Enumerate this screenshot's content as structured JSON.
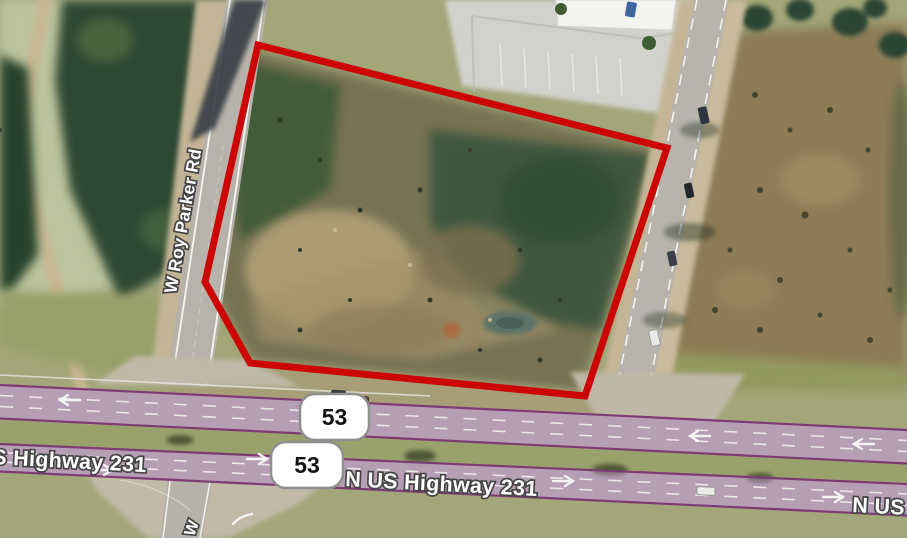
{
  "map": {
    "view": "satellite",
    "labels": {
      "road_vertical": "W Roy Parker Rd",
      "highway_left_partial": "S Highway 231",
      "highway_center": "N US Highway 231",
      "highway_right_partial": "N US",
      "road_south_partial": "W"
    },
    "shields": [
      {
        "number": "53"
      },
      {
        "number": "53"
      }
    ],
    "colors": {
      "parcel_outline": "#cc0606",
      "highway_overlay": "#b98fc0",
      "highway_edge": "#7d3c74",
      "label_text": "#ffffff",
      "label_outline": "#454545",
      "shield_bg": "#ffffff",
      "shield_border": "#8f8f8f",
      "shield_text": "#141414"
    }
  }
}
